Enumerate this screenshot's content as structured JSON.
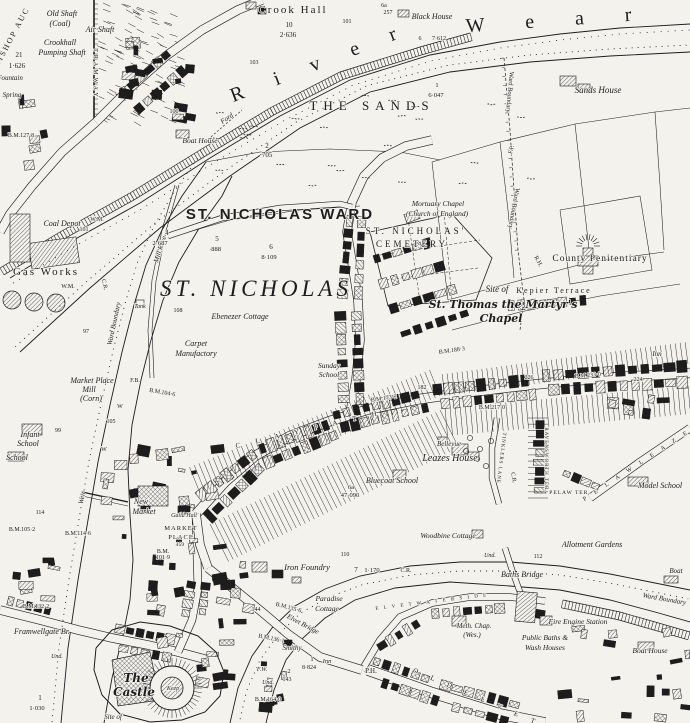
{
  "map": {
    "paper_color": "#f4f2ed",
    "ink_color": "#1d1d1d",
    "labels": [
      {
        "t": "BISHOP AUC",
        "x": 14,
        "y": 38,
        "s": 8,
        "r": -62,
        "l": 2
      },
      {
        "t": "Old Shaft",
        "x": 62,
        "y": 16,
        "s": 8,
        "i": 1
      },
      {
        "t": "(Coal)",
        "x": 60,
        "y": 26,
        "s": 8,
        "i": 1
      },
      {
        "t": "Air Shaft",
        "x": 100,
        "y": 32,
        "s": 8,
        "i": 1
      },
      {
        "t": "Crookhall",
        "x": 60,
        "y": 45,
        "s": 8,
        "i": 1
      },
      {
        "t": "Pumping Shaft",
        "x": 62,
        "y": 55,
        "s": 8,
        "i": 1
      },
      {
        "t": "21",
        "x": 19,
        "y": 57,
        "s": 7
      },
      {
        "t": "1·626",
        "x": 17,
        "y": 68,
        "s": 7
      },
      {
        "t": "Fountain",
        "x": 10,
        "y": 80,
        "s": 7,
        "i": 1
      },
      {
        "t": "Spring",
        "x": 12,
        "y": 97,
        "s": 7,
        "i": 1
      },
      {
        "t": "TRAMWAY",
        "x": 94,
        "y": 74,
        "s": 6,
        "r": 90,
        "l": 3
      },
      {
        "t": "Crook Hall",
        "x": 293,
        "y": 13,
        "s": 11,
        "l": 2
      },
      {
        "t": "10",
        "x": 289,
        "y": 27,
        "s": 7
      },
      {
        "t": "2·636",
        "x": 288,
        "y": 37,
        "s": 7
      },
      {
        "t": "6a",
        "x": 384,
        "y": 7,
        "s": 6
      },
      {
        "t": "257",
        "x": 388,
        "y": 14,
        "s": 6
      },
      {
        "t": "Black House",
        "x": 432,
        "y": 19,
        "s": 8,
        "i": 1
      },
      {
        "t": "101",
        "x": 347,
        "y": 23,
        "s": 6
      },
      {
        "t": "103",
        "x": 254,
        "y": 64,
        "s": 6
      },
      {
        "t": "R  i  v  e  r",
        "x": 322,
        "y": 68,
        "s": 20,
        "r": -21,
        "l": 14
      },
      {
        "t": "W  e  a  r",
        "x": 558,
        "y": 26,
        "s": 20,
        "r": -4,
        "l": 18
      },
      {
        "t": "6",
        "x": 420,
        "y": 40,
        "s": 6
      },
      {
        "t": "7·612",
        "x": 439,
        "y": 40,
        "s": 6
      },
      {
        "t": "1",
        "x": 437,
        "y": 87,
        "s": 6.5
      },
      {
        "t": "6·047",
        "x": 436,
        "y": 97,
        "s": 6.5
      },
      {
        "t": "THE  SANDS",
        "x": 372,
        "y": 110,
        "s": 13,
        "l": 6
      },
      {
        "t": "Ford",
        "x": 228,
        "y": 120,
        "s": 7,
        "i": 1,
        "r": -35
      },
      {
        "t": "2",
        "x": 267,
        "y": 148,
        "s": 7
      },
      {
        "t": "·705",
        "x": 266,
        "y": 157,
        "s": 7
      },
      {
        "t": "Boat House",
        "x": 200,
        "y": 143,
        "s": 7.5,
        "i": 1
      },
      {
        "t": "Sands House",
        "x": 598,
        "y": 93,
        "s": 9,
        "i": 1
      },
      {
        "t": "B.M.127·8",
        "x": 21,
        "y": 137,
        "s": 6
      },
      {
        "t": "100",
        "x": 174,
        "y": 113,
        "s": 6
      },
      {
        "t": "F.P.",
        "x": 513,
        "y": 150,
        "s": 6,
        "r": -75
      },
      {
        "t": "Ward Boundary",
        "x": 508,
        "y": 92,
        "s": 6.5,
        "r": 95
      },
      {
        "t": "Ward Boundary",
        "x": 512,
        "y": 208,
        "s": 6.5,
        "r": 100
      },
      {
        "t": "R.H.",
        "x": 537,
        "y": 262,
        "s": 6,
        "r": 60
      },
      {
        "t": "Coal Depot",
        "x": 62,
        "y": 226,
        "s": 8,
        "i": 1
      },
      {
        "t": "W.M.",
        "x": 97,
        "y": 221,
        "s": 6
      },
      {
        "t": "101",
        "x": 84,
        "y": 231,
        "s": 6
      },
      {
        "t": "Gas Works",
        "x": 46,
        "y": 275,
        "s": 11,
        "l": 2
      },
      {
        "t": "W.M.",
        "x": 68,
        "y": 288,
        "s": 6
      },
      {
        "t": "C.R.",
        "x": 103,
        "y": 285,
        "s": 6,
        "r": 75
      },
      {
        "t": "Ward Boundary",
        "x": 116,
        "y": 324,
        "s": 7,
        "i": 1,
        "r": -78
      },
      {
        "t": "Mill Race",
        "x": 162,
        "y": 250,
        "s": 7,
        "i": 1,
        "r": -72
      },
      {
        "t": "4",
        "x": 167,
        "y": 235,
        "s": 7
      },
      {
        "t": "2·687",
        "x": 160,
        "y": 245,
        "s": 6.5
      },
      {
        "t": "5",
        "x": 217,
        "y": 241,
        "s": 7
      },
      {
        "t": "·888",
        "x": 215,
        "y": 251,
        "s": 6.5
      },
      {
        "t": "ST. NICHOLAS WARD",
        "x": 280,
        "y": 219,
        "s": 15,
        "f": "sans",
        "l": 2
      },
      {
        "t": "6",
        "x": 271,
        "y": 249,
        "s": 7
      },
      {
        "t": "8·109",
        "x": 269,
        "y": 259,
        "s": 6.5
      },
      {
        "t": "ST. NICHOLAS",
        "x": 256,
        "y": 296,
        "s": 23,
        "i": 1,
        "l": 4
      },
      {
        "t": "Ebenezer Cottage",
        "x": 240,
        "y": 319,
        "s": 8,
        "i": 1
      },
      {
        "t": "Mortuary Chapel",
        "x": 438,
        "y": 206,
        "s": 7.5,
        "i": 1
      },
      {
        "t": "(Church of England)",
        "x": 437,
        "y": 216,
        "s": 7.5,
        "i": 1
      },
      {
        "t": "ST.  NICHOLAS'",
        "x": 416,
        "y": 234,
        "s": 9,
        "l": 3
      },
      {
        "t": "CEMETERY",
        "x": 412,
        "y": 247,
        "s": 9,
        "l": 3
      },
      {
        "t": "County Penitentiary",
        "x": 600,
        "y": 261,
        "s": 9.5,
        "l": 1
      },
      {
        "t": "Kepier Terrace",
        "x": 554,
        "y": 293,
        "s": 8,
        "l": 2
      },
      {
        "t": "Site of",
        "x": 497,
        "y": 292,
        "s": 9,
        "i": 1
      },
      {
        "t": "St. Thomas the Martyr's",
        "x": 503,
        "y": 308,
        "s": 11,
        "f": "bl"
      },
      {
        "t": "Chapel",
        "x": 501,
        "y": 322,
        "s": 11,
        "f": "bl"
      },
      {
        "t": "Inn",
        "x": 657,
        "y": 356,
        "s": 7,
        "i": 1
      },
      {
        "t": "B.M.188·3",
        "x": 452,
        "y": 352,
        "s": 6,
        "r": -8
      },
      {
        "t": "Carpet",
        "x": 196,
        "y": 346,
        "s": 8,
        "i": 1
      },
      {
        "t": "Manufactory",
        "x": 196,
        "y": 356,
        "s": 8,
        "i": 1
      },
      {
        "t": "Market Place",
        "x": 92,
        "y": 383,
        "s": 8,
        "i": 1
      },
      {
        "t": "Mill",
        "x": 89,
        "y": 392,
        "s": 8,
        "i": 1
      },
      {
        "t": "(Corn)",
        "x": 91,
        "y": 401,
        "s": 8,
        "i": 1
      },
      {
        "t": "F.B.",
        "x": 135,
        "y": 382,
        "s": 6
      },
      {
        "t": "B.M.104·6",
        "x": 162,
        "y": 394,
        "s": 6,
        "r": 10
      },
      {
        "t": "Infant",
        "x": 30,
        "y": 437,
        "s": 8,
        "i": 1
      },
      {
        "t": "School",
        "x": 28,
        "y": 446,
        "s": 8,
        "i": 1
      },
      {
        "t": "School",
        "x": 17,
        "y": 460,
        "s": 8,
        "i": 1
      },
      {
        "t": "99",
        "x": 58,
        "y": 432,
        "s": 6
      },
      {
        "t": "W",
        "x": 120,
        "y": 408,
        "s": 6
      },
      {
        "t": "105",
        "x": 111,
        "y": 423,
        "s": 6
      },
      {
        "t": "W",
        "x": 104,
        "y": 451,
        "s": 6
      },
      {
        "t": "Weir",
        "x": 84,
        "y": 498,
        "s": 7,
        "i": 1,
        "r": -80
      },
      {
        "t": "114",
        "x": 40,
        "y": 514,
        "s": 6
      },
      {
        "t": "B.M.114·6",
        "x": 78,
        "y": 535,
        "s": 6
      },
      {
        "t": "B.M.105·2",
        "x": 22,
        "y": 531,
        "s": 6
      },
      {
        "t": "New",
        "x": 141,
        "y": 504,
        "s": 8,
        "i": 1
      },
      {
        "t": "Market",
        "x": 144,
        "y": 514,
        "s": 8,
        "i": 1
      },
      {
        "t": "Guild Hall",
        "x": 184,
        "y": 517,
        "s": 6,
        "i": 1
      },
      {
        "t": "MARKET",
        "x": 181,
        "y": 530,
        "s": 6.5,
        "l": 1
      },
      {
        "t": "PLACE",
        "x": 181,
        "y": 539,
        "s": 6.5,
        "l": 1
      },
      {
        "t": "159",
        "x": 180,
        "y": 546,
        "s": 5.5
      },
      {
        "t": "B.M.",
        "x": 163,
        "y": 553,
        "s": 6
      },
      {
        "t": "101·9",
        "x": 163,
        "y": 559,
        "s": 6
      },
      {
        "t": "Sunday",
        "x": 329,
        "y": 368,
        "s": 7.5,
        "i": 1
      },
      {
        "t": "School",
        "x": 329,
        "y": 377,
        "s": 7.5,
        "i": 1
      },
      {
        "t": "C L A Y P A T H",
        "x": 310,
        "y": 431,
        "s": 7,
        "r": -13,
        "l": 7
      },
      {
        "t": "B.M.173·2",
        "x": 384,
        "y": 400,
        "s": 6,
        "r": -8
      },
      {
        "t": "182",
        "x": 422,
        "y": 389,
        "s": 6
      },
      {
        "t": "Bellevue",
        "x": 449,
        "y": 446,
        "s": 7,
        "i": 1
      },
      {
        "t": "Leazes House",
        "x": 450,
        "y": 461,
        "s": 10,
        "i": 1
      },
      {
        "t": "Bluecoat School",
        "x": 392,
        "y": 483,
        "s": 8,
        "i": 1
      },
      {
        "t": "6a",
        "x": 351,
        "y": 489,
        "s": 6.5
      },
      {
        "t": "47·090",
        "x": 350,
        "y": 497,
        "s": 6.5
      },
      {
        "t": "Woodbine Cottage",
        "x": 448,
        "y": 538,
        "s": 7.5,
        "i": 1
      },
      {
        "t": "B.M.233·0",
        "x": 588,
        "y": 377,
        "s": 6,
        "r": -5
      },
      {
        "t": "226",
        "x": 529,
        "y": 379,
        "s": 6
      },
      {
        "t": "224",
        "x": 638,
        "y": 381,
        "s": 6
      },
      {
        "t": "B.M.217·0",
        "x": 492,
        "y": 409,
        "s": 6
      },
      {
        "t": "RAVENSWORTH TER.",
        "x": 545,
        "y": 460,
        "s": 5,
        "r": 90,
        "l": 1
      },
      {
        "t": "PELAW TER.",
        "x": 570,
        "y": 494,
        "s": 5.5,
        "l": 1
      },
      {
        "t": "TINKLERS LANE",
        "x": 500,
        "y": 458,
        "s": 5,
        "r": 97,
        "l": 1
      },
      {
        "t": "C.R.",
        "x": 512,
        "y": 478,
        "s": 6,
        "r": 80
      },
      {
        "t": "P E L A W   L E A Z E S",
        "x": 643,
        "y": 463,
        "s": 6,
        "r": -33,
        "l": 4
      },
      {
        "t": "Model School",
        "x": 660,
        "y": 488,
        "s": 8,
        "i": 1
      },
      {
        "t": "Allotment Gardens",
        "x": 592,
        "y": 547,
        "s": 8,
        "i": 1
      },
      {
        "t": "Baths Bridge",
        "x": 522,
        "y": 577,
        "s": 8,
        "i": 1
      },
      {
        "t": "Ward Boundary",
        "x": 664,
        "y": 601,
        "s": 7,
        "i": 1,
        "r": 10
      },
      {
        "t": "Boat",
        "x": 676,
        "y": 573,
        "s": 7,
        "i": 1
      },
      {
        "t": "Boat House",
        "x": 650,
        "y": 653,
        "s": 7.5,
        "i": 1
      },
      {
        "t": "Fire Engine Station",
        "x": 578,
        "y": 624,
        "s": 7.5,
        "i": 1
      },
      {
        "t": "Public Baths &",
        "x": 545,
        "y": 640,
        "s": 7.5,
        "i": 1
      },
      {
        "t": "Wash Houses",
        "x": 545,
        "y": 650,
        "s": 7.5,
        "i": 1
      },
      {
        "t": "Meth. Chap.",
        "x": 474,
        "y": 628,
        "s": 7,
        "i": 1
      },
      {
        "t": "(Wes.)",
        "x": 472,
        "y": 637,
        "s": 7,
        "i": 1
      },
      {
        "t": "112",
        "x": 538,
        "y": 558,
        "s": 6
      },
      {
        "t": "Und.",
        "x": 490,
        "y": 557,
        "s": 6,
        "i": 1
      },
      {
        "t": "E L V E T   W A T E R S I D E",
        "x": 432,
        "y": 603,
        "s": 5,
        "r": -7,
        "l": 2
      },
      {
        "t": "7",
        "x": 356,
        "y": 572,
        "s": 7
      },
      {
        "t": "1·170",
        "x": 372,
        "y": 572,
        "s": 6.5
      },
      {
        "t": "C.R.",
        "x": 406,
        "y": 572,
        "s": 6
      },
      {
        "t": "110",
        "x": 345,
        "y": 556,
        "s": 6
      },
      {
        "t": "Iron Foundry",
        "x": 307,
        "y": 570,
        "s": 8.5,
        "i": 1
      },
      {
        "t": "Paradise",
        "x": 329,
        "y": 601,
        "s": 7.5,
        "i": 1
      },
      {
        "t": "Cottage",
        "x": 327,
        "y": 611,
        "s": 7.5,
        "i": 1
      },
      {
        "t": "Elvet Bridge",
        "x": 302,
        "y": 626,
        "s": 7,
        "i": 1,
        "r": 28
      },
      {
        "t": "B.M.135·6",
        "x": 288,
        "y": 609,
        "s": 6,
        "r": 15
      },
      {
        "t": "B.M.136·1",
        "x": 271,
        "y": 640,
        "s": 6,
        "r": 12
      },
      {
        "t": "Smithy",
        "x": 292,
        "y": 650,
        "s": 7,
        "i": 1
      },
      {
        "t": "144",
        "x": 256,
        "y": 611,
        "s": 6
      },
      {
        "t": "Inn",
        "x": 327,
        "y": 663,
        "s": 6.5,
        "i": 1
      },
      {
        "t": "1",
        "x": 312,
        "y": 661,
        "s": 6.5
      },
      {
        "t": "8·824",
        "x": 309,
        "y": 669,
        "s": 6
      },
      {
        "t": "P.H.",
        "x": 371,
        "y": 673,
        "s": 7
      },
      {
        "t": "O L D   E L V E T",
        "x": 476,
        "y": 699,
        "s": 7,
        "r": 23,
        "l": 6
      },
      {
        "t": "F.W.",
        "x": 262,
        "y": 671,
        "s": 6,
        "i": 1
      },
      {
        "t": "2",
        "x": 289,
        "y": 673,
        "s": 6.5
      },
      {
        "t": "143",
        "x": 287,
        "y": 681,
        "s": 6
      },
      {
        "t": "Und.",
        "x": 268,
        "y": 684,
        "s": 6,
        "i": 1
      },
      {
        "t": "B.M.164·0",
        "x": 268,
        "y": 701,
        "s": 6
      },
      {
        "t": "B.M.132·2",
        "x": 36,
        "y": 608,
        "s": 6
      },
      {
        "t": "Framwellgate Br.",
        "x": 42,
        "y": 634,
        "s": 8,
        "i": 1
      },
      {
        "t": "Und.",
        "x": 57,
        "y": 658,
        "s": 6,
        "i": 1
      },
      {
        "t": "The",
        "x": 136,
        "y": 682,
        "s": 12,
        "f": "bl"
      },
      {
        "t": "Castle",
        "x": 134,
        "y": 696,
        "s": 12,
        "f": "bl"
      },
      {
        "t": "Keep",
        "x": 173,
        "y": 690,
        "s": 6,
        "i": 1
      },
      {
        "t": "Site of",
        "x": 113,
        "y": 719,
        "s": 7,
        "i": 1
      },
      {
        "t": "1",
        "x": 40,
        "y": 700,
        "s": 7
      },
      {
        "t": "1·030",
        "x": 37,
        "y": 710,
        "s": 6.5
      },
      {
        "t": "Tank",
        "x": 140,
        "y": 308,
        "s": 6,
        "i": 1
      },
      {
        "t": "97",
        "x": 86,
        "y": 333,
        "s": 6
      },
      {
        "t": "108",
        "x": 178,
        "y": 312,
        "s": 6
      }
    ]
  }
}
